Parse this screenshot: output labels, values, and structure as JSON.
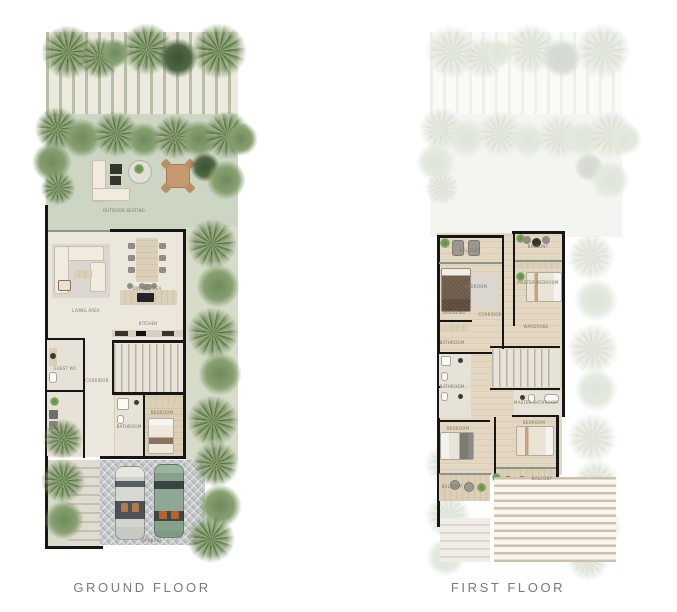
{
  "page": {
    "background": "#ffffff"
  },
  "colors": {
    "wall": "#161616",
    "lawn": "#cdd5c3",
    "paving_stripe": "#b6bfa4",
    "paving": "#eceade",
    "floor": "#ece7dd",
    "wood": "#d8caaf",
    "driveway": "#c3c6c7",
    "palm_dark": "#55713f",
    "palm_light": "#93a87e",
    "car_white": "#d8d8d2",
    "car_green": "#8fa893",
    "outdoor_table_tan": "#c6996e",
    "caption_text": "#7a7a7a",
    "label_text": "#7c756a"
  },
  "plans": [
    {
      "caption": "GROUND FLOOR",
      "labels": [
        [
          84,
          186,
          "OUTDOOR SEATING"
        ],
        [
          46,
          286,
          "LIVING AREA"
        ],
        [
          107,
          264,
          "DINING AREA"
        ],
        [
          108,
          299,
          "KITCHEN"
        ],
        [
          25,
          344,
          "GUEST WC"
        ],
        [
          57,
          356,
          "CORRIDOR"
        ],
        [
          25,
          408,
          "LAUNDRY"
        ],
        [
          89,
          402,
          "BATHROOM"
        ],
        [
          122,
          388,
          "BEDROOM"
        ],
        [
          112,
          516,
          "PARKING"
        ]
      ]
    },
    {
      "caption": "FIRST FLOOR",
      "labels": [
        [
          46,
          226,
          "BALCONY"
        ],
        [
          114,
          222,
          "BALCONY"
        ],
        [
          52,
          262,
          "BEDROOM"
        ],
        [
          114,
          258,
          "MASTER BEDROOM"
        ],
        [
          30,
          288,
          "DRESSING"
        ],
        [
          66,
          290,
          "CORRIDOR"
        ],
        [
          28,
          318,
          "BATHROOM"
        ],
        [
          112,
          302,
          "WARDROBE"
        ],
        [
          28,
          362,
          "BATHROOM"
        ],
        [
          112,
          378,
          "MASTER BATHROOM"
        ],
        [
          34,
          404,
          "BEDROOM"
        ],
        [
          110,
          398,
          "BEDROOM"
        ],
        [
          28,
          462,
          "BALCONY"
        ],
        [
          118,
          454,
          "BALCONY"
        ]
      ]
    }
  ],
  "vegetation": {
    "ground": [
      [
        0,
        2,
        56,
        "palm"
      ],
      [
        38,
        14,
        44,
        "palm"
      ],
      [
        80,
        0,
        54,
        "palm"
      ],
      [
        60,
        16,
        30,
        "bush"
      ],
      [
        118,
        16,
        40,
        "bush-dark"
      ],
      [
        150,
        0,
        58,
        "palm"
      ],
      [
        -6,
        84,
        46,
        "palm"
      ],
      [
        22,
        96,
        40,
        "bush"
      ],
      [
        52,
        88,
        48,
        "palm"
      ],
      [
        86,
        100,
        36,
        "bush"
      ],
      [
        112,
        92,
        46,
        "palm"
      ],
      [
        140,
        98,
        38,
        "bush"
      ],
      [
        162,
        88,
        50,
        "palm"
      ],
      [
        184,
        100,
        34,
        "bush"
      ],
      [
        -8,
        120,
        40,
        "bush"
      ],
      [
        0,
        148,
        36,
        "palm"
      ],
      [
        150,
        130,
        30,
        "bush-dark"
      ],
      [
        166,
        138,
        40,
        "bush"
      ],
      [
        146,
        196,
        52,
        "palm"
      ],
      [
        156,
        242,
        44,
        "bush"
      ],
      [
        146,
        284,
        54,
        "palm"
      ],
      [
        158,
        330,
        44,
        "bush"
      ],
      [
        146,
        372,
        54,
        "palm"
      ],
      [
        152,
        418,
        48,
        "palm"
      ],
      [
        158,
        462,
        44,
        "bush"
      ],
      [
        146,
        492,
        50,
        "palm"
      ],
      [
        2,
        396,
        42,
        "palm"
      ],
      [
        0,
        436,
        46,
        "palm"
      ],
      [
        4,
        478,
        40,
        "bush"
      ]
    ],
    "first": [
      [
        0,
        2,
        56,
        "palm"
      ],
      [
        38,
        14,
        44,
        "palm"
      ],
      [
        80,
        0,
        54,
        "palm"
      ],
      [
        60,
        16,
        30,
        "bush"
      ],
      [
        118,
        16,
        40,
        "bush-dark"
      ],
      [
        150,
        0,
        58,
        "palm"
      ],
      [
        -6,
        84,
        46,
        "palm"
      ],
      [
        22,
        96,
        40,
        "bush"
      ],
      [
        52,
        88,
        48,
        "palm"
      ],
      [
        86,
        100,
        36,
        "bush"
      ],
      [
        112,
        92,
        46,
        "palm"
      ],
      [
        140,
        98,
        38,
        "bush"
      ],
      [
        162,
        88,
        50,
        "palm"
      ],
      [
        184,
        100,
        34,
        "bush"
      ],
      [
        -8,
        120,
        40,
        "bush"
      ],
      [
        0,
        148,
        36,
        "palm"
      ],
      [
        150,
        130,
        30,
        "bush-dark"
      ],
      [
        166,
        138,
        40,
        "bush"
      ],
      [
        142,
        210,
        50,
        "palm"
      ],
      [
        150,
        256,
        44,
        "bush"
      ],
      [
        142,
        300,
        54,
        "palm"
      ],
      [
        150,
        346,
        44,
        "bush"
      ],
      [
        142,
        390,
        52,
        "palm"
      ],
      [
        148,
        436,
        48,
        "palm"
      ],
      [
        152,
        482,
        46,
        "bush"
      ],
      [
        142,
        516,
        44,
        "palm"
      ],
      [
        0,
        420,
        44,
        "palm"
      ],
      [
        0,
        470,
        48,
        "palm"
      ],
      [
        2,
        515,
        40,
        "bush"
      ]
    ]
  }
}
